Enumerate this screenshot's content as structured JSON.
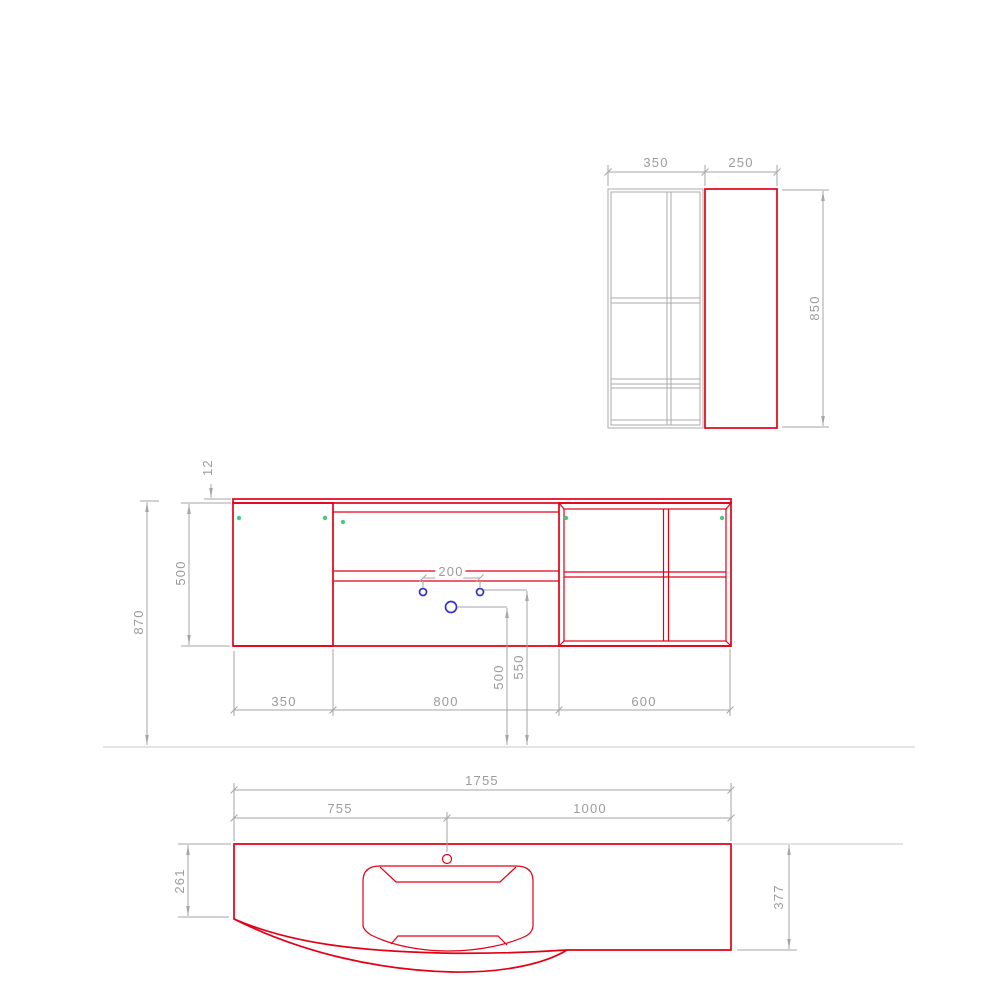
{
  "drawing": {
    "colors": {
      "red": "#e30017",
      "cabinet": "#ababab",
      "dimline": "#a6a6a6",
      "dimtext": "#9b9b9b",
      "faint": "#d2d2d2",
      "green": "#4cc97e",
      "blue": "#3531cf",
      "background": "#ffffff"
    },
    "side_view": {
      "width_main": "350",
      "width_panel": "250",
      "height": "850"
    },
    "front_view": {
      "top_thickness": "12",
      "body_height": "500",
      "total_height": "870",
      "tap_hole_spacing": "200",
      "section_left_width": "350",
      "section_middle_width": "800",
      "section_right_width": "600",
      "drain_outlet_height": "500",
      "water_supply_height": "550"
    },
    "plan_view": {
      "total_width": "1755",
      "left_edge_to_tap": "755",
      "tap_to_right_edge": "1000",
      "left_depth": "261",
      "right_depth": "377"
    }
  }
}
